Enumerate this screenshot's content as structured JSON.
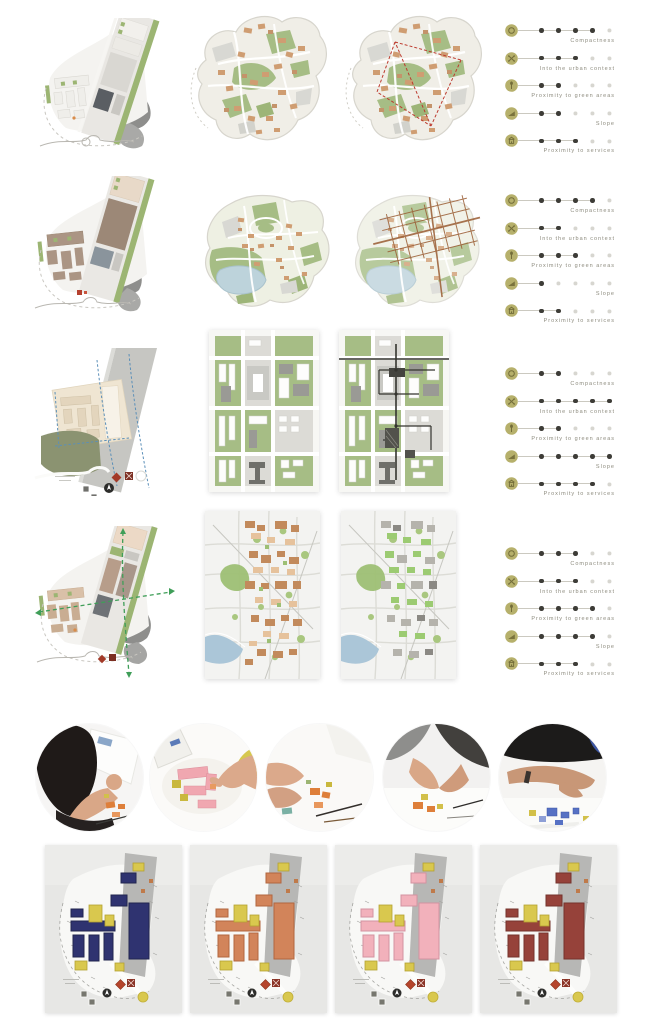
{
  "palette": {
    "accent_olive": "#b6b06b",
    "icon_glyph": "#736d39",
    "dot_filled": "#3d3c37",
    "dot_empty": "#d7d6d0",
    "label_text": "#8d8b7e",
    "map_green": "#a6bd85",
    "map_tan": "#cf9d72",
    "map_gray": "#8f8f8b",
    "lake_blue": "#bdd3db",
    "river_blue": "#abc6d8",
    "overlay_red": "#bd3a2e",
    "overlay_brown": "#9a5c33",
    "overlay_dark": "#34342f",
    "model_yellow": "#d9c84e"
  },
  "site_options": [
    {
      "id": "option-1",
      "criteria": [
        {
          "icon": "compactness-icon",
          "label": "Compactness",
          "value": 4,
          "max": 5
        },
        {
          "icon": "urban-context-icon",
          "label": "Into the urban context",
          "value": 3,
          "max": 5
        },
        {
          "icon": "green-areas-icon",
          "label": "Proximity to green areas",
          "value": 2,
          "max": 5
        },
        {
          "icon": "slope-icon",
          "label": "Slope",
          "value": 2,
          "max": 5
        },
        {
          "icon": "services-icon",
          "label": "Proximity to services",
          "value": 3,
          "max": 5
        }
      ]
    },
    {
      "id": "option-2",
      "criteria": [
        {
          "icon": "compactness-icon",
          "label": "Compactness",
          "value": 4,
          "max": 5
        },
        {
          "icon": "urban-context-icon",
          "label": "Into the urban context",
          "value": 2,
          "max": 5
        },
        {
          "icon": "green-areas-icon",
          "label": "Proximity to green areas",
          "value": 3,
          "max": 5
        },
        {
          "icon": "slope-icon",
          "label": "Slope",
          "value": 1,
          "max": 5
        },
        {
          "icon": "services-icon",
          "label": "Proximity to services",
          "value": 2,
          "max": 5
        }
      ]
    },
    {
      "id": "option-3",
      "criteria": [
        {
          "icon": "compactness-icon",
          "label": "Compactness",
          "value": 2,
          "max": 5
        },
        {
          "icon": "urban-context-icon",
          "label": "Into the urban context",
          "value": 5,
          "max": 5
        },
        {
          "icon": "green-areas-icon",
          "label": "Proximity to green areas",
          "value": 2,
          "max": 5
        },
        {
          "icon": "slope-icon",
          "label": "Slope",
          "value": 5,
          "max": 5
        },
        {
          "icon": "services-icon",
          "label": "Proximity to services",
          "value": 4,
          "max": 5
        }
      ]
    },
    {
      "id": "option-4",
      "criteria": [
        {
          "icon": "compactness-icon",
          "label": "Compactness",
          "value": 3,
          "max": 5
        },
        {
          "icon": "urban-context-icon",
          "label": "Into the urban context",
          "value": 3,
          "max": 5
        },
        {
          "icon": "green-areas-icon",
          "label": "Proximity to green areas",
          "value": 4,
          "max": 5
        },
        {
          "icon": "slope-icon",
          "label": "Slope",
          "value": 4,
          "max": 5
        },
        {
          "icon": "services-icon",
          "label": "Proximity to services",
          "value": 3,
          "max": 5
        }
      ]
    }
  ],
  "process_photos": [
    {
      "name": "photo-person-building-model"
    },
    {
      "name": "photo-hands-pink-blocks"
    },
    {
      "name": "photo-hands-orange-blocks"
    },
    {
      "name": "photo-group-discussion-blocks"
    },
    {
      "name": "photo-arm-blue-blocks"
    }
  ],
  "model_variants": [
    {
      "name": "massing-model-navy",
      "color": "#2f3370",
      "color_dark": "#22264f",
      "accent": "#d9c84e"
    },
    {
      "name": "massing-model-orange",
      "color": "#d2845a",
      "color_dark": "#b2663f",
      "accent": "#d9c84e"
    },
    {
      "name": "massing-model-pink",
      "color": "#f2b1bb",
      "color_dark": "#d392a0",
      "accent": "#d9c84e"
    },
    {
      "name": "massing-model-maroon",
      "color": "#96423a",
      "color_dark": "#75332c",
      "accent": "#d9c84e"
    }
  ]
}
